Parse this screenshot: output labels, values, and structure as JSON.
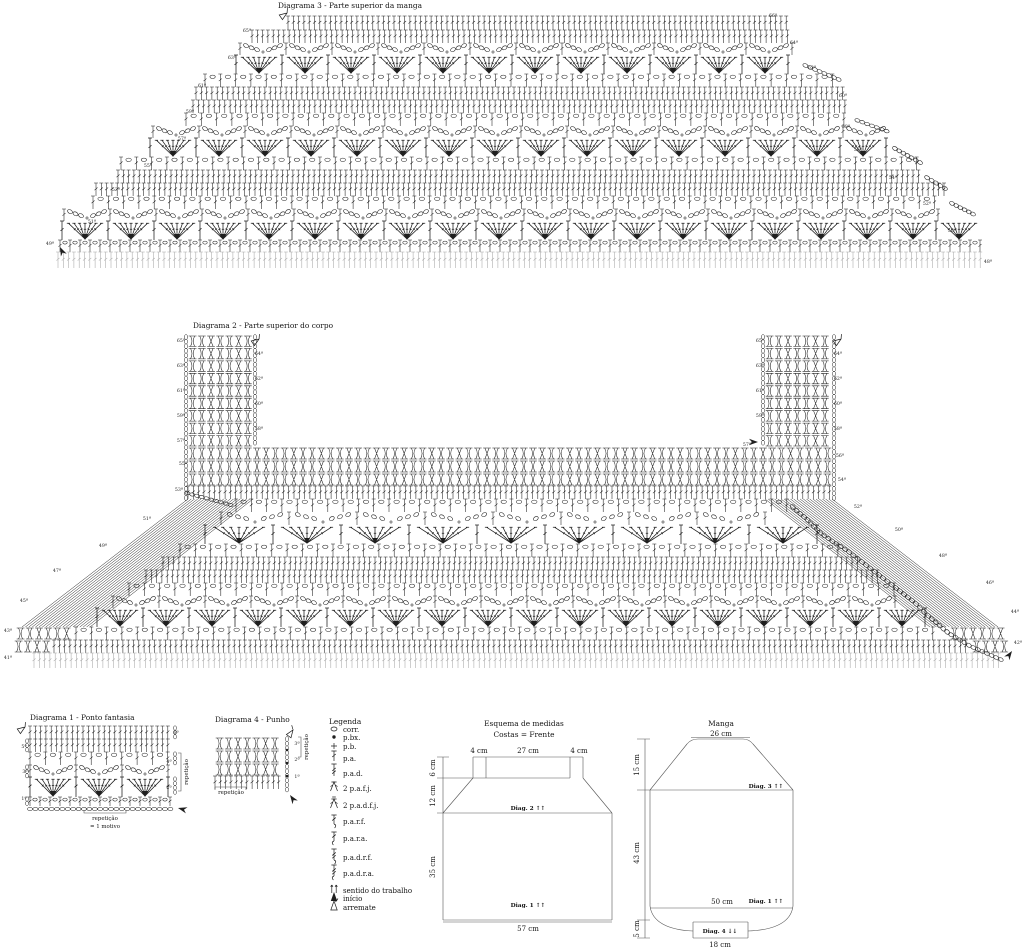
{
  "colors": {
    "ink": "#1f1f1f",
    "pale": "#a8a8a8",
    "line": "#555555"
  },
  "diagram3": {
    "title": "Diagrama 3 - Parte superior da manga",
    "bands": [
      {
        "t": "dc",
        "y": 16,
        "h": 14,
        "x1": 288,
        "x2": 788
      },
      {
        "t": "dc",
        "y": 30,
        "h": 13,
        "x1": 252,
        "x2": 792
      },
      {
        "t": "arc",
        "y": 43,
        "h": 12,
        "x1": 240,
        "x2": 798
      },
      {
        "t": "fan",
        "y": 55,
        "h": 19,
        "x1": 236,
        "x2": 800
      },
      {
        "t": "mesh",
        "y": 74,
        "h": 13,
        "x1": 205,
        "x2": 838
      },
      {
        "t": "dc",
        "y": 87,
        "h": 13,
        "x1": 196,
        "x2": 844
      },
      {
        "t": "dc",
        "y": 100,
        "h": 13,
        "x1": 193,
        "x2": 848
      },
      {
        "t": "mesh",
        "y": 113,
        "h": 13,
        "x1": 186,
        "x2": 852
      },
      {
        "t": "arc",
        "y": 126,
        "h": 12,
        "x1": 153,
        "x2": 886
      },
      {
        "t": "fan",
        "y": 138,
        "h": 19,
        "x1": 150,
        "x2": 890
      },
      {
        "t": "mesh",
        "y": 157,
        "h": 13,
        "x1": 121,
        "x2": 919
      },
      {
        "t": "dc",
        "y": 170,
        "h": 13,
        "x1": 118,
        "x2": 922
      },
      {
        "t": "dc",
        "y": 183,
        "h": 13,
        "x1": 96,
        "x2": 944
      },
      {
        "t": "mesh",
        "y": 196,
        "h": 13,
        "x1": 93,
        "x2": 947
      },
      {
        "t": "arc",
        "y": 209,
        "h": 12,
        "x1": 64,
        "x2": 972
      },
      {
        "t": "fan",
        "y": 221,
        "h": 19,
        "x1": 62,
        "x2": 976
      },
      {
        "t": "meshS",
        "y": 240,
        "h": 12,
        "x1": 60,
        "x2": 980
      },
      {
        "t": "pale",
        "y": 252,
        "h": 16,
        "x1": 58,
        "x2": 982
      }
    ],
    "row_labels": [
      {
        "t": "49ª",
        "x": 50,
        "y": 245
      },
      {
        "t": "51ª",
        "x": 92,
        "y": 223
      },
      {
        "t": "53ª",
        "x": 116,
        "y": 191
      },
      {
        "t": "55ª",
        "x": 148,
        "y": 167
      },
      {
        "t": "57ª",
        "x": 182,
        "y": 140
      },
      {
        "t": "59ª",
        "x": 190,
        "y": 113
      },
      {
        "t": "61ª",
        "x": 202,
        "y": 87
      },
      {
        "t": "63ª",
        "x": 232,
        "y": 59
      },
      {
        "t": "65ª",
        "x": 247,
        "y": 32
      },
      {
        "t": "48ª",
        "x": 988,
        "y": 263
      },
      {
        "t": "50ª",
        "x": 952,
        "y": 232
      },
      {
        "t": "52ª",
        "x": 927,
        "y": 205
      },
      {
        "t": "54ª",
        "x": 893,
        "y": 179
      },
      {
        "t": "56ª",
        "x": 858,
        "y": 151
      },
      {
        "t": "58ª",
        "x": 846,
        "y": 128
      },
      {
        "t": "60ª",
        "x": 843,
        "y": 97
      },
      {
        "t": "62ª",
        "x": 812,
        "y": 69
      },
      {
        "t": "64ª",
        "x": 794,
        "y": 44
      },
      {
        "t": "66ª",
        "x": 773,
        "y": 17
      }
    ],
    "markers": {
      "start": [
        {
          "x": 60,
          "y": 247,
          "a": -115
        }
      ],
      "end": [
        {
          "x": 287,
          "y": 13,
          "a": -35
        }
      ]
    }
  },
  "diagram2": {
    "title": "Diagrama 2 - Parte superior do corpo",
    "columns": {
      "y1": 335,
      "y2": 447,
      "rows": 9,
      "left": {
        "x1": 188,
        "x2": 253
      },
      "right": {
        "x1": 765,
        "x2": 832
      }
    },
    "ribband": {
      "x1": 188,
      "x2": 832,
      "rows": [
        {
          "y": 447,
          "h": 13
        },
        {
          "y": 460,
          "h": 13
        },
        {
          "y": 473,
          "h": 13
        }
      ]
    },
    "bands": [
      {
        "t": "dc",
        "y": 486,
        "h": 13,
        "x1": 188,
        "x2": 832
      },
      {
        "t": "mesh",
        "y": 499,
        "h": 13,
        "x1": 236,
        "x2": 788
      },
      {
        "t": "arc",
        "y": 512,
        "h": 13,
        "x1": 221,
        "x2": 803,
        "p": 68
      },
      {
        "t": "fan",
        "y": 525,
        "h": 19,
        "x1": 205,
        "x2": 819,
        "p": 68
      },
      {
        "t": "mesh",
        "y": 544,
        "h": 13,
        "x1": 180,
        "x2": 844
      },
      {
        "t": "dc",
        "y": 557,
        "h": 13,
        "x1": 163,
        "x2": 861
      },
      {
        "t": "dc",
        "y": 570,
        "h": 13,
        "x1": 146,
        "x2": 878
      },
      {
        "t": "mesh",
        "y": 583,
        "h": 13,
        "x1": 129,
        "x2": 895
      },
      {
        "t": "arc",
        "y": 596,
        "h": 12,
        "x1": 113,
        "x2": 911
      },
      {
        "t": "fan",
        "y": 608,
        "h": 19,
        "x1": 97,
        "x2": 927
      },
      {
        "t": "mesh",
        "y": 627,
        "h": 13,
        "x1": 76,
        "x2": 946
      },
      {
        "t": "dc",
        "y": 640,
        "h": 13,
        "x1": 54,
        "x2": 968
      },
      {
        "t": "pale",
        "y": 653,
        "h": 15,
        "x1": 34,
        "x2": 1000
      }
    ],
    "corner_ribs": [
      {
        "t": "rib",
        "y": 627,
        "h": 13,
        "x1": 16,
        "x2": 72
      },
      {
        "t": "rib",
        "y": 640,
        "h": 13,
        "x1": 14,
        "x2": 50
      },
      {
        "t": "rib",
        "y": 627,
        "h": 13,
        "x1": 950,
        "x2": 1004
      },
      {
        "t": "rib",
        "y": 640,
        "h": 13,
        "x1": 972,
        "x2": 1008
      }
    ],
    "hatch": [
      [
        [
          188,
          499
        ],
        [
          253,
          499
        ],
        [
          22,
          627
        ],
        [
          90,
          627
        ]
      ],
      [
        [
          765,
          499
        ],
        [
          832,
          499
        ],
        [
          930,
          627
        ],
        [
          998,
          627
        ]
      ]
    ],
    "row_labels": [
      {
        "t": "65ª",
        "x": 181,
        "y": 342
      },
      {
        "t": "63ª",
        "x": 181,
        "y": 367
      },
      {
        "t": "61ª",
        "x": 181,
        "y": 392
      },
      {
        "t": "59ª",
        "x": 181,
        "y": 417
      },
      {
        "t": "57ª",
        "x": 181,
        "y": 442
      },
      {
        "t": "55ª",
        "x": 183,
        "y": 465
      },
      {
        "t": "53ª",
        "x": 179,
        "y": 491
      },
      {
        "t": "51ª",
        "x": 147,
        "y": 520
      },
      {
        "t": "49ª",
        "x": 103,
        "y": 547
      },
      {
        "t": "47ª",
        "x": 57,
        "y": 572
      },
      {
        "t": "45ª",
        "x": 24,
        "y": 602
      },
      {
        "t": "43ª",
        "x": 8,
        "y": 632
      },
      {
        "t": "41ª",
        "x": 8,
        "y": 659
      },
      {
        "t": "64ª",
        "x": 259,
        "y": 355
      },
      {
        "t": "62ª",
        "x": 259,
        "y": 380
      },
      {
        "t": "60ª",
        "x": 259,
        "y": 405
      },
      {
        "t": "58ª",
        "x": 259,
        "y": 430
      },
      {
        "t": "65ª",
        "x": 760,
        "y": 342
      },
      {
        "t": "63ª",
        "x": 760,
        "y": 367
      },
      {
        "t": "61ª",
        "x": 760,
        "y": 392
      },
      {
        "t": "59ª",
        "x": 760,
        "y": 417
      },
      {
        "t": "57ª",
        "x": 747,
        "y": 446
      },
      {
        "t": "64ª",
        "x": 838,
        "y": 355
      },
      {
        "t": "62ª",
        "x": 838,
        "y": 380
      },
      {
        "t": "60ª",
        "x": 838,
        "y": 405
      },
      {
        "t": "58ª",
        "x": 838,
        "y": 430
      },
      {
        "t": "56ª",
        "x": 840,
        "y": 457
      },
      {
        "t": "54ª",
        "x": 842,
        "y": 481
      },
      {
        "t": "52ª",
        "x": 858,
        "y": 508
      },
      {
        "t": "50ª",
        "x": 899,
        "y": 531
      },
      {
        "t": "48ª",
        "x": 943,
        "y": 557
      },
      {
        "t": "46ª",
        "x": 990,
        "y": 584
      },
      {
        "t": "44ª",
        "x": 1015,
        "y": 613
      },
      {
        "t": "42ª",
        "x": 1018,
        "y": 644
      }
    ],
    "markers": {
      "start": [
        {
          "x": 758,
          "y": 442,
          "a": 0
        },
        {
          "x": 1012,
          "y": 651,
          "a": -55
        }
      ],
      "end": [
        {
          "x": 259,
          "y": 339,
          "a": -35
        },
        {
          "x": 841,
          "y": 339,
          "a": -35
        }
      ]
    }
  },
  "diagram1": {
    "title": "Diagrama 1 - Ponto fantasia",
    "bands": [
      {
        "t": "dc",
        "y": 726,
        "h": 13,
        "x1": 30,
        "x2": 172,
        "edge": "R"
      },
      {
        "t": "dc",
        "y": 739,
        "h": 13,
        "x1": 30,
        "x2": 172,
        "edge": "L"
      },
      {
        "t": "mesh",
        "y": 752,
        "h": 13,
        "x1": 30,
        "x2": 172,
        "edge": "R"
      },
      {
        "t": "arc",
        "y": 765,
        "h": 12,
        "x1": 30,
        "x2": 172,
        "edge": "L"
      },
      {
        "t": "fan",
        "y": 777,
        "h": 20,
        "x1": 30,
        "x2": 172,
        "edge": "R"
      },
      {
        "t": "meshS",
        "y": 797,
        "h": 9,
        "x1": 30,
        "x2": 172,
        "edge": "L"
      },
      {
        "t": "chain",
        "y": 806,
        "h": 6,
        "x1": 30,
        "x2": 172
      }
    ],
    "row_labels": [
      {
        "t": "5ª",
        "x": 24,
        "y": 748
      },
      {
        "t": "3ª",
        "x": 25,
        "y": 773
      },
      {
        "t": "1ª",
        "x": 24,
        "y": 800
      },
      {
        "t": "6ª",
        "x": 176,
        "y": 734
      },
      {
        "t": "4ª",
        "x": 169,
        "y": 763
      },
      {
        "t": "2ª",
        "x": 169,
        "y": 789
      }
    ],
    "side_bracket": {
      "x": 181,
      "y1": 753,
      "y2": 791,
      "label": "repetição",
      "lx": 188,
      "ly": 772
    },
    "bottom_bracket": {
      "x1": 84,
      "x2": 126,
      "y": 813,
      "cx": 105,
      "label1": "repetição",
      "ly1": 820,
      "label2": "= 1 motivo",
      "ly2": 828
    },
    "markers": {
      "start": [
        {
          "x": 178,
          "y": 808,
          "a": 195
        }
      ],
      "end": [
        {
          "x": 25,
          "y": 727,
          "a": -35
        }
      ]
    }
  },
  "diagram4": {
    "title": "Diagrama 4 - Punho",
    "rib_rows": [
      {
        "t": "rib",
        "y": 737,
        "h": 13,
        "x1": 215,
        "x2": 283
      },
      {
        "t": "rib",
        "y": 750,
        "h": 13,
        "x1": 215,
        "x2": 283
      },
      {
        "t": "rib",
        "y": 763,
        "h": 13,
        "x1": 215,
        "x2": 283
      },
      {
        "t": "dc",
        "y": 776,
        "h": 13,
        "x1": 215,
        "x2": 283
      }
    ],
    "chain_column": {
      "x": 287,
      "y1": 737,
      "y2": 791,
      "dots": [
        750,
        763,
        776
      ]
    },
    "row_labels": [
      {
        "t": "3ª",
        "x": 297,
        "y": 745
      },
      {
        "t": "2ª",
        "x": 297,
        "y": 761
      },
      {
        "t": "1ª",
        "x": 297,
        "y": 778
      }
    ],
    "side_bracket": {
      "x": 301,
      "y1": 737,
      "y2": 757,
      "label": "repetição",
      "lx": 308,
      "ly": 747
    },
    "bottom_bracket": {
      "x1": 215,
      "x2": 246,
      "y": 787,
      "cx": 231,
      "label": "repetição",
      "ly": 794
    },
    "markers": {
      "start": [
        {
          "x": 290,
          "y": 795,
          "a": -125
        }
      ],
      "end": [
        {
          "x": 293,
          "y": 730,
          "a": -55
        }
      ]
    }
  },
  "legend": {
    "title": "Legenda",
    "icon_x": 334,
    "label_x": 343,
    "items": [
      {
        "icon": "chain",
        "label": "corr.",
        "y": 732
      },
      {
        "icon": "slip",
        "label": "p.bx.",
        "y": 740
      },
      {
        "icon": "sc",
        "label": "p.b.",
        "y": 749
      },
      {
        "icon": "dc",
        "label": "p.a.",
        "y": 761
      },
      {
        "icon": "tr",
        "label": "p.a.d.",
        "y": 776
      },
      {
        "icon": "dc2tog",
        "label": "2 p.a.f.j.",
        "y": 791
      },
      {
        "icon": "tr2tog",
        "label": "2 p.a.d.f.j.",
        "y": 808
      },
      {
        "icon": "fpdc",
        "label": "p.a.r.f.",
        "y": 824
      },
      {
        "icon": "bpdc",
        "label": "p.a.r.a.",
        "y": 841
      },
      {
        "icon": "fptr",
        "label": "p.a.d.r.f.",
        "y": 860
      },
      {
        "icon": "bptr",
        "label": "p.a.d.r.a.",
        "y": 876
      },
      {
        "icon": "dir",
        "label": "sentido do trabalho",
        "y": 893
      },
      {
        "icon": "start",
        "label": "início",
        "y": 901
      },
      {
        "icon": "end",
        "label": "arremate",
        "y": 910
      }
    ]
  },
  "esquema": {
    "title": "Esquema de medidas",
    "subtitle": "Costas = Frente",
    "top_labels": [
      {
        "t": "4 cm",
        "x": 479
      },
      {
        "t": "27 cm",
        "x": 528
      },
      {
        "t": "4 cm",
        "x": 579
      }
    ],
    "top_y": 753,
    "left_labels": [
      {
        "t": "6 cm",
        "y": 768
      },
      {
        "t": "12 cm",
        "y": 796
      },
      {
        "t": "35 cm",
        "y": 867
      }
    ],
    "left_x": 435,
    "bottom_label": {
      "t": "57 cm",
      "x": 528,
      "y": 931
    },
    "inner_labels": [
      {
        "t": "Diag. 2 ↑↑",
        "x": 528,
        "y": 810
      },
      {
        "t": "Diag. 1 ↑↑",
        "x": 528,
        "y": 907
      }
    ]
  },
  "manga": {
    "title": "Manga",
    "top_label": "26 cm",
    "left_labels": [
      {
        "t": "15 cm",
        "y": 765
      },
      {
        "t": "43 cm",
        "y": 853
      },
      {
        "t": "5 cm",
        "y": 929
      }
    ],
    "left_x": 639,
    "width_label": {
      "t": "50 cm",
      "x": 722,
      "y": 904
    },
    "bottom_label": {
      "t": "18 cm",
      "x": 720,
      "y": 947
    },
    "inner_labels": [
      {
        "t": "Diag. 3 ↑↑",
        "x": 766,
        "y": 788
      },
      {
        "t": "Diag. 1 ↑↑",
        "x": 766,
        "y": 903
      },
      {
        "t": "Diag. 4 ↓↓",
        "x": 720,
        "y": 933
      }
    ]
  }
}
